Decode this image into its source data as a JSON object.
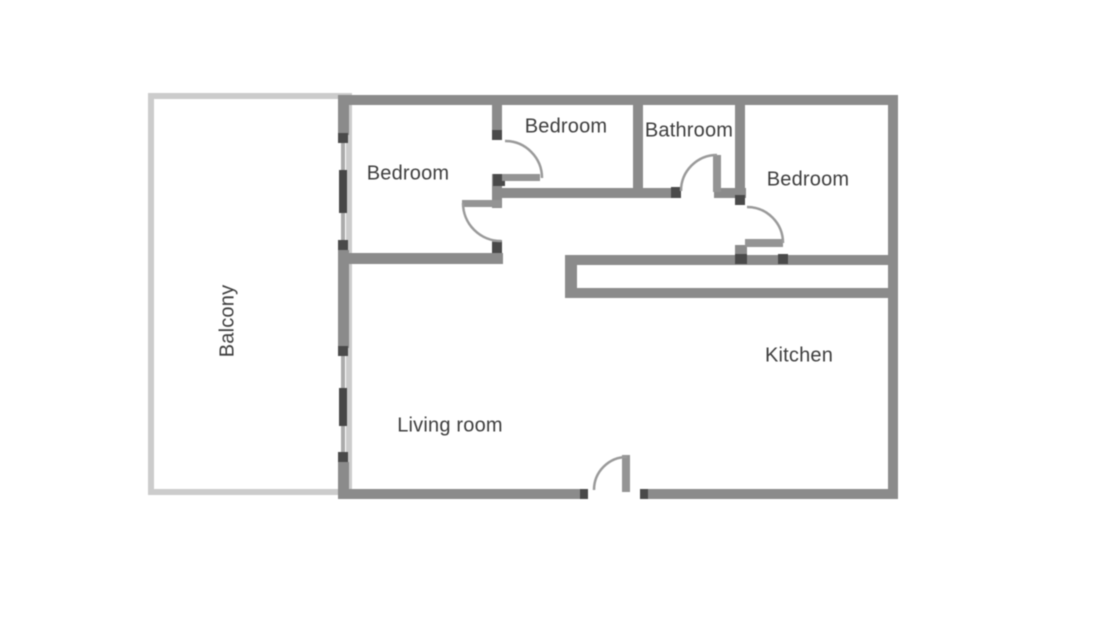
{
  "diagram_type": "apartment floor plan",
  "colors": {
    "background": "#ffffff",
    "wall": "#8b8b8b",
    "balcony_border": "#cccccc",
    "door_arc": "#9a9a9a",
    "window_dark": "#474747",
    "label_text": "#3d3d3d"
  },
  "rooms": {
    "balcony": {
      "label": "Balcony"
    },
    "bedroom_left": {
      "label": "Bedroom"
    },
    "bedroom_top": {
      "label": "Bedroom"
    },
    "bathroom": {
      "label": "Bathroom"
    },
    "bedroom_right": {
      "label": "Bedroom"
    },
    "kitchen": {
      "label": "Kitchen"
    },
    "living_room": {
      "label": "Living room"
    }
  }
}
